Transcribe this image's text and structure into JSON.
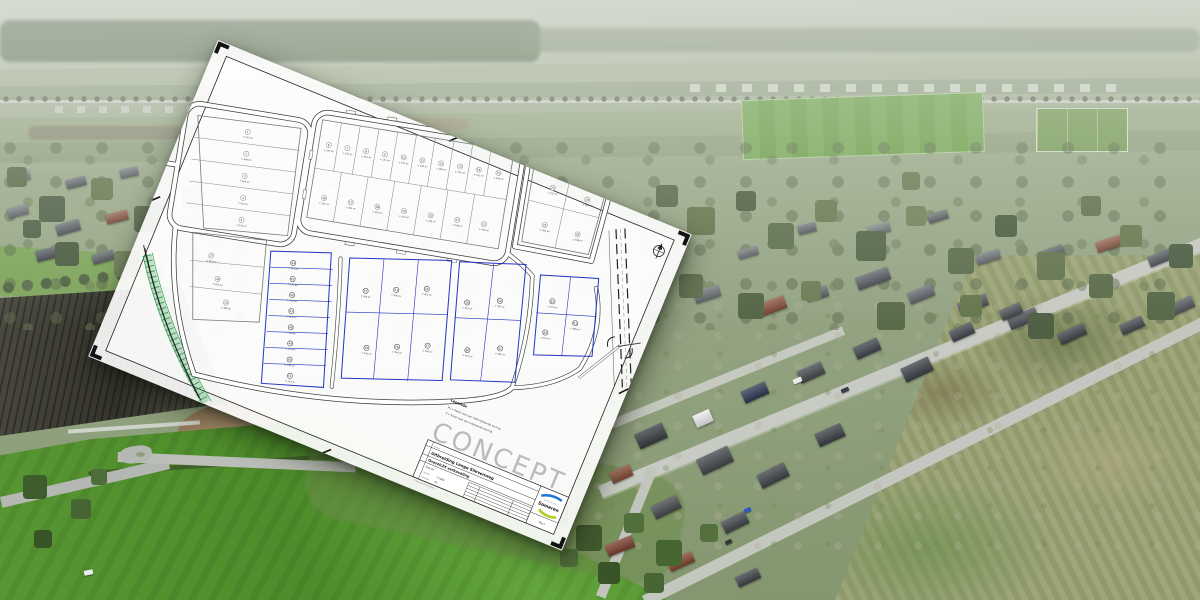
{
  "plan": {
    "watermark": "CONCEPT",
    "legend": {
      "title": "Legenda",
      "items": [
        "PV = Kavel voor een halfvrijstaande woning",
        "V  = Kavel voor een vrijstaande woning"
      ]
    },
    "title_block": {
      "project": "Uitbreiding Lange Slievenweg",
      "drawing": "Overzicht verkaveling",
      "phase": "fase 2b",
      "fields": [
        {
          "label": "schaal",
          "value": "1:1000"
        },
        {
          "label": "formaat",
          "value": "A3"
        }
      ],
      "municipality_prefix": "gemeente",
      "municipality": "Someren",
      "page": "Pag 1",
      "copyright": "© gemeente Someren"
    },
    "colors": {
      "new_lot_outline": "#2334c4",
      "existing_lot_outline": "#9a9a9a",
      "green_zone": "#2f9e4e",
      "logo_blue": "#1976d2",
      "logo_yellow": "#b5cc1e"
    },
    "lots": [
      {
        "n": "1",
        "a": "± 512 m²",
        "x": 86,
        "y": 52,
        "c": "g"
      },
      {
        "n": "2",
        "a": "± 490 m²",
        "x": 88,
        "y": 74,
        "c": "g"
      },
      {
        "n": "3",
        "a": "± 505 m²",
        "x": 90,
        "y": 96,
        "c": "g"
      },
      {
        "n": "4",
        "a": "± 520 m²",
        "x": 92,
        "y": 118,
        "c": "g"
      },
      {
        "n": "5",
        "a": "± 575 m²",
        "x": 94,
        "y": 140,
        "c": "g"
      },
      {
        "n": "6",
        "a": "± 337 m²",
        "x": 168,
        "y": 52,
        "c": "g"
      },
      {
        "n": "7",
        "a": "± 152 m²",
        "x": 187,
        "y": 52,
        "c": "g"
      },
      {
        "n": "8",
        "a": "± 152 m²",
        "x": 206,
        "y": 52,
        "c": "g"
      },
      {
        "n": "9",
        "a": "± 152 m²",
        "x": 225,
        "y": 52,
        "c": "g"
      },
      {
        "n": "10",
        "a": "± 152 m²",
        "x": 244,
        "y": 52,
        "c": "g"
      },
      {
        "n": "11",
        "a": "± 160 m²",
        "x": 263,
        "y": 52,
        "c": "g"
      },
      {
        "n": "12",
        "a": "± 160 m²",
        "x": 282,
        "y": 52,
        "c": "g"
      },
      {
        "n": "13",
        "a": "± 152 m²",
        "x": 301,
        "y": 52,
        "c": "g"
      },
      {
        "n": "14",
        "a": "± 152 m²",
        "x": 320,
        "y": 52,
        "c": "g"
      },
      {
        "n": "15",
        "a": "± 340 m²",
        "x": 340,
        "y": 52,
        "c": "g"
      },
      {
        "n": "16",
        "a": "± 302 m²",
        "x": 172,
        "y": 105,
        "c": "g"
      },
      {
        "n": "17",
        "a": "± 305 m²",
        "x": 199,
        "y": 105,
        "c": "g"
      },
      {
        "n": "18",
        "a": "± 310 m²",
        "x": 226,
        "y": 105,
        "c": "g"
      },
      {
        "n": "19",
        "a": "± 322 m²",
        "x": 253,
        "y": 105,
        "c": "g"
      },
      {
        "n": "20",
        "a": "± 335 m²",
        "x": 280,
        "y": 105,
        "c": "g"
      },
      {
        "n": "21",
        "a": "± 348 m²",
        "x": 307,
        "y": 105,
        "c": "g"
      },
      {
        "n": "22",
        "a": "± 420 m²",
        "x": 334,
        "y": 105,
        "c": "g"
      },
      {
        "n": "23",
        "a": "± 512 m²",
        "x": 396,
        "y": 58,
        "c": "g"
      },
      {
        "n": "24",
        "a": "± 540 m²",
        "x": 432,
        "y": 64,
        "c": "g"
      },
      {
        "n": "25",
        "a": "± 560 m²",
        "x": 394,
        "y": 96,
        "c": "g"
      },
      {
        "n": "26",
        "a": "± 498 m²",
        "x": 428,
        "y": 100,
        "c": "g"
      },
      {
        "n": "27",
        "a": "± 415 m²",
        "x": 70,
        "y": 180,
        "c": "g"
      },
      {
        "n": "28",
        "a": "± 392 m²",
        "x": 80,
        "y": 202,
        "c": "g"
      },
      {
        "n": "29",
        "a": "± 388 m²",
        "x": 92,
        "y": 224,
        "c": "g"
      },
      {
        "n": "44",
        "a": "± 213 m²",
        "x": 152,
        "y": 174,
        "c": "b"
      },
      {
        "n": "45",
        "a": "± 211 m²",
        "x": 154,
        "y": 190,
        "c": "b"
      },
      {
        "n": "46",
        "a": "± 213 m²",
        "x": 156,
        "y": 206,
        "c": "b"
      },
      {
        "n": "47",
        "a": "± 213 m²",
        "x": 158,
        "y": 222,
        "c": "b"
      },
      {
        "n": "48",
        "a": "± 213 m²",
        "x": 160,
        "y": 238,
        "c": "b"
      },
      {
        "n": "49",
        "a": "± 213 m²",
        "x": 162,
        "y": 254,
        "c": "b"
      },
      {
        "n": "50",
        "a": "± 240 m²",
        "x": 164,
        "y": 270,
        "c": "b"
      },
      {
        "n": "51",
        "a": "± 253 m²",
        "x": 167,
        "y": 286,
        "c": "b"
      },
      {
        "n": "52",
        "a": "± 508 m²",
        "x": 228,
        "y": 190,
        "c": "b"
      },
      {
        "n": "53",
        "a": "± 306 m²",
        "x": 258,
        "y": 184,
        "c": "b"
      },
      {
        "n": "54",
        "a": "± 305 m²",
        "x": 288,
        "y": 178,
        "c": "b"
      },
      {
        "n": "55",
        "a": "± 341 m²",
        "x": 238,
        "y": 246,
        "c": "b"
      },
      {
        "n": "56",
        "a": "± 346 m²",
        "x": 268,
        "y": 240,
        "c": "b"
      },
      {
        "n": "57",
        "a": "± 300 m²",
        "x": 298,
        "y": 234,
        "c": "b"
      },
      {
        "n": "58",
        "a": "± 433 m²",
        "x": 330,
        "y": 185,
        "c": "b"
      },
      {
        "n": "59",
        "a": "± 461 m²",
        "x": 362,
        "y": 178,
        "c": "b"
      },
      {
        "n": "60",
        "a": "± 452 m²",
        "x": 338,
        "y": 232,
        "c": "b"
      },
      {
        "n": "61",
        "a": "± 561 m²",
        "x": 370,
        "y": 225,
        "c": "b"
      },
      {
        "n": "62",
        "a": "± 512 m²",
        "x": 414,
        "y": 170,
        "c": "b"
      },
      {
        "n": "63",
        "a": "± 489 m²",
        "x": 440,
        "y": 188,
        "c": "b"
      },
      {
        "n": "64",
        "a": "± 554 m²",
        "x": 412,
        "y": 202,
        "c": "b"
      }
    ]
  }
}
